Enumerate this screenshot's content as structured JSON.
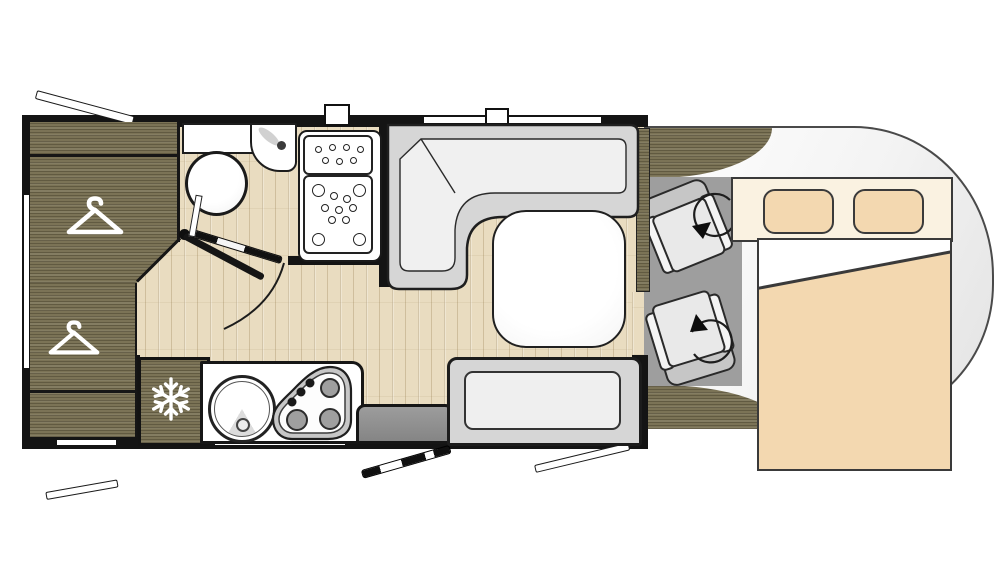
{
  "diagram": {
    "kind": "motorhome-floor-plan-top-view",
    "zones": [
      {
        "id": "wardrobe-upper",
        "icon": "hanger-icon"
      },
      {
        "id": "wardrobe-lower",
        "icon": "hanger-icon"
      },
      {
        "id": "refrigerator",
        "icon": "snowflake-icon"
      },
      {
        "id": "bathroom",
        "fixtures": [
          "toilet",
          "corner-washbasin",
          "vanity-shelf",
          "shower-tray",
          "bifold-door"
        ]
      },
      {
        "id": "kitchen",
        "fixtures": [
          "round-sink",
          "three-burner-hob"
        ]
      },
      {
        "id": "dinette",
        "fixtures": [
          "l-shaped-bench",
          "table",
          "side-bench"
        ]
      },
      {
        "id": "entrance",
        "fixtures": [
          "entry-step",
          "entry-door"
        ]
      },
      {
        "id": "cab",
        "fixtures": [
          "driver-swivel-seat",
          "passenger-swivel-seat",
          "dashboard"
        ],
        "icon": "swivel-arrow-icon"
      },
      {
        "id": "drop-down-bed",
        "fixtures": [
          "pillow",
          "pillow",
          "duvet"
        ]
      }
    ],
    "openings": {
      "windows_open_flaps": 3,
      "window_strips": 5,
      "roof_vents": 2,
      "doors": [
        "bathroom-bifold-door",
        "entry-door"
      ]
    }
  },
  "colors": {
    "woodDark": "#7b7356",
    "floorLight": "#e9dcc0",
    "wall": "#141414",
    "cabFloor": "#9e9e9e",
    "benchGray": "#d6d6d6",
    "beige": "#f3d8b0",
    "cream": "#faf2e1",
    "white": "#ffffff",
    "outline": "#1a1a1a"
  },
  "icons": [
    "hanger-icon",
    "hanger-icon",
    "snowflake-icon",
    "swivel-arrow-icon",
    "swivel-arrow-icon"
  ]
}
